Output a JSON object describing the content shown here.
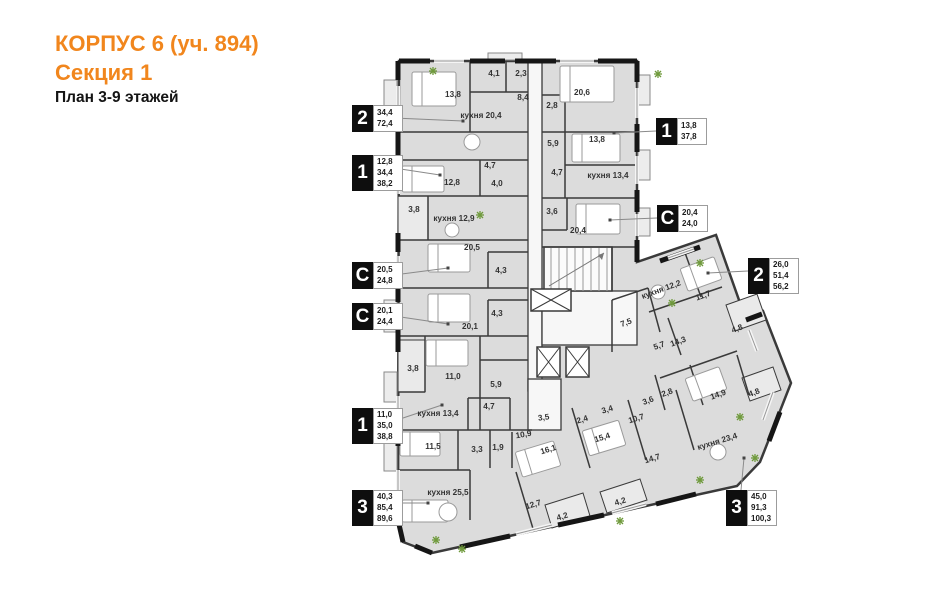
{
  "title": {
    "line1": "КОРПУС 6 (уч. 894)",
    "line2": "Секция 1",
    "line3": "План 3-9 этажей"
  },
  "colors": {
    "accent_orange": "#f1861d",
    "wall": "#3a3a3a",
    "room_fill": "#dcdcdc",
    "loggia_fill": "#eaeaea",
    "corridor_fill": "#f7f7f7",
    "plant_green": "#6f9a3c",
    "legend_box": "#0e0e0e"
  },
  "legend": [
    {
      "type": "2",
      "areas": [
        "34,4",
        "72,4"
      ]
    },
    {
      "type": "1",
      "areas": [
        "12,8",
        "34,4",
        "38,2"
      ]
    },
    {
      "type": "С",
      "areas": [
        "20,5",
        "24,8"
      ]
    },
    {
      "type": "С",
      "areas": [
        "20,1",
        "24,4"
      ]
    },
    {
      "type": "1",
      "areas": [
        "11,0",
        "35,0",
        "38,8"
      ]
    },
    {
      "type": "3",
      "areas": [
        "40,3",
        "85,4",
        "89,6"
      ]
    },
    {
      "type": "1",
      "areas": [
        "13,8",
        "37,8"
      ]
    },
    {
      "type": "С",
      "areas": [
        "20,4",
        "24,0"
      ]
    },
    {
      "type": "2",
      "areas": [
        "26,0",
        "51,4",
        "56,2"
      ]
    },
    {
      "type": "3",
      "areas": [
        "45,0",
        "91,3",
        "100,3"
      ]
    }
  ],
  "plan": {
    "rooms": [
      "13,8",
      "4,1",
      "2,3",
      "8,4",
      "кухня 20,4",
      "20,6",
      "2,8",
      "5,9",
      "13,8",
      "4,7",
      "кухня 13,4",
      "3,6",
      "20,4",
      "12,8",
      "4,0",
      "4,7",
      "3,8",
      "кухня 12,9",
      "20,5",
      "4,3",
      "20,1",
      "4,3",
      "3,8",
      "11,0",
      "5,9",
      "4,7",
      "кухня 13,4",
      "11,5",
      "3,3",
      "1,9",
      "кухня 25,5",
      "12,7",
      "4,2",
      "10,9",
      "16,1",
      "3,5",
      "2,4",
      "3,4",
      "10,7",
      "15,4",
      "14,7",
      "кухня 23,4",
      "4,2",
      "7,5",
      "кухня 12,2",
      "11,7",
      "5,7",
      "14,3",
      "4,8",
      "3,6",
      "2,8",
      "14,9",
      "4,8"
    ]
  }
}
